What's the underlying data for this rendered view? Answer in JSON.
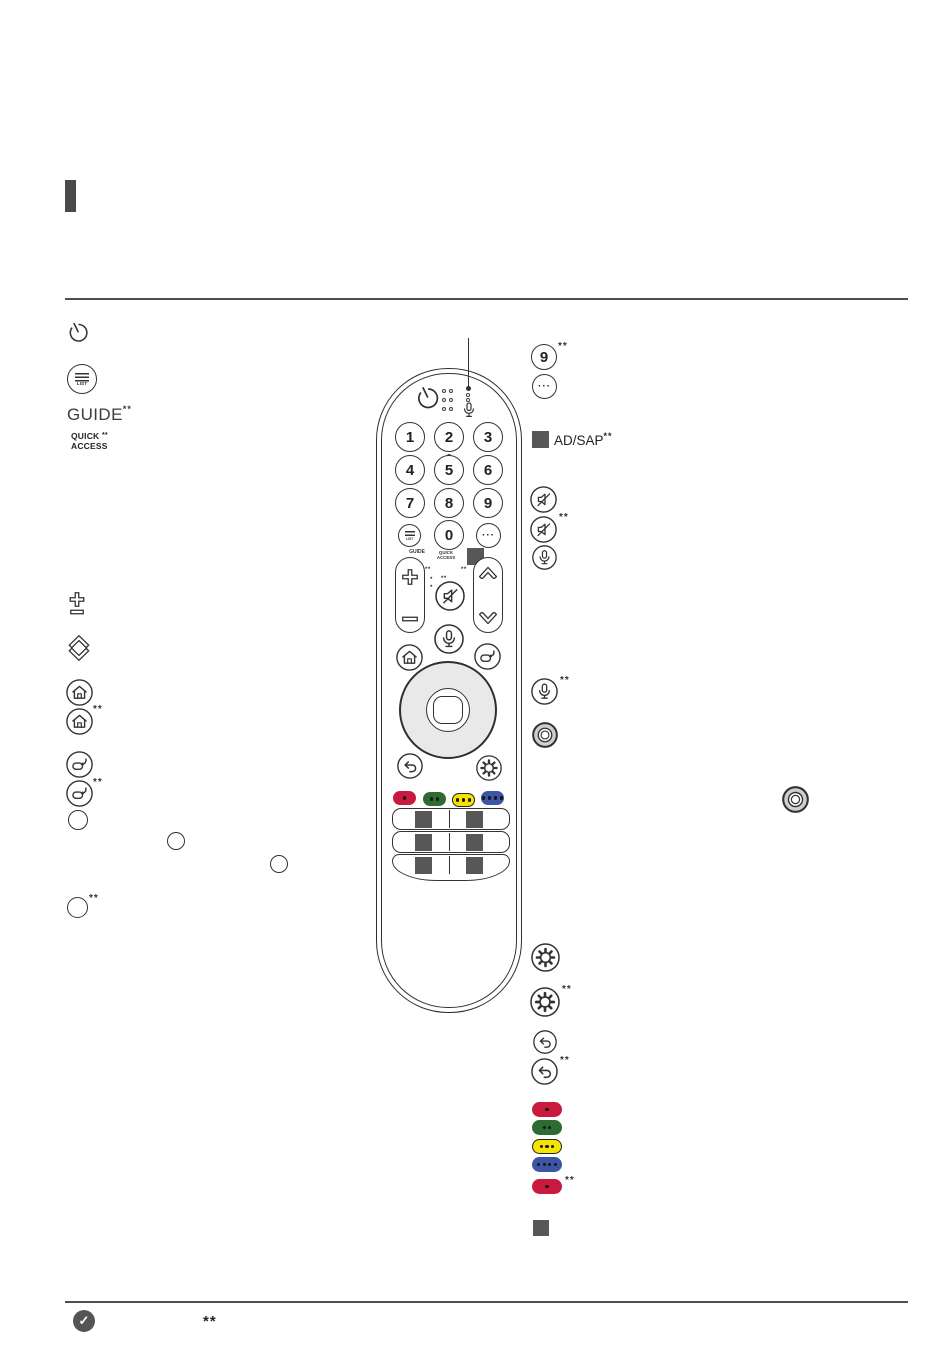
{
  "colors": {
    "ink": "#333333",
    "accent_bar": "#4a4a4a",
    "rule": "#4f4f4f",
    "masked_square": "#575757",
    "wheel_fill": "#e9e9e9",
    "pill_red": "#c9193c",
    "pill_green": "#2e6b33",
    "pill_yellow": "#f4e400",
    "pill_blue": "#3c55a4"
  },
  "footnote": "**",
  "footnote_single": "*",
  "left_column": {
    "list_label": "LIST",
    "guide_label": "GUIDE",
    "quick_line1": "QUICK",
    "quick_line2": "ACCESS"
  },
  "remote": {
    "digits": [
      "1",
      "2",
      "3",
      "4",
      "5",
      "6",
      "7",
      "8",
      "9"
    ],
    "zero": "0",
    "list_label": "LIST",
    "guide_label": "GUIDE",
    "quick_line1": "QUICK",
    "quick_line2": "ACCESS",
    "ellipsis": "···"
  },
  "right_column": {
    "nine_label": "9",
    "ellipsis": "···",
    "adsap_label": "AD/SAP"
  },
  "footer": {
    "check_glyph": "✓",
    "note_marker": "**"
  }
}
